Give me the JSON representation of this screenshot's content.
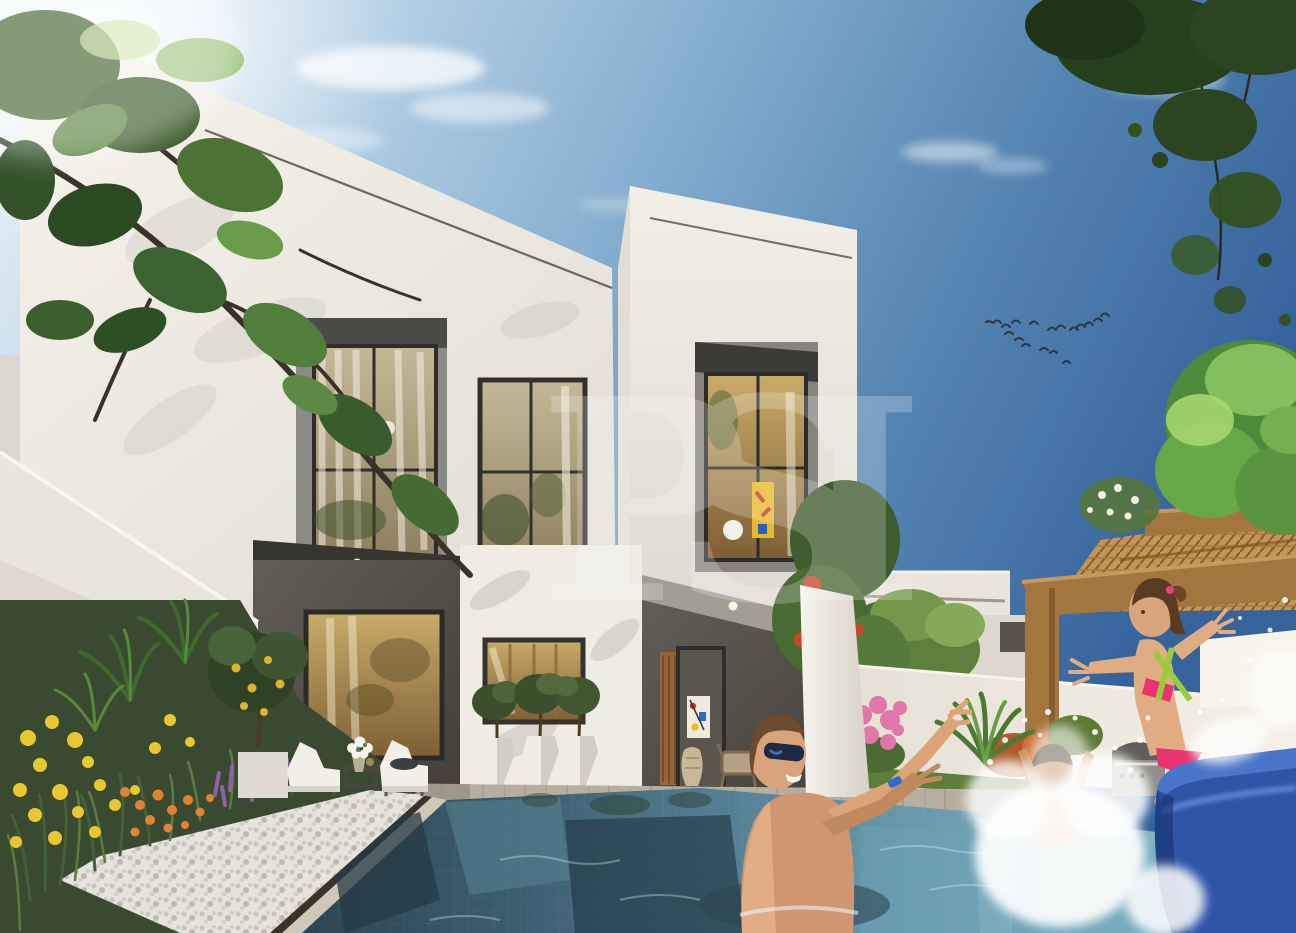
{
  "page": {
    "title": "Modern villa backyard pool — architectural rendering"
  },
  "watermark": {
    "text": "PSI"
  },
  "scene": {
    "setting": "Sunny backyard of a modern two-storey white villa with a private mosaic-tile pool",
    "sky": {
      "condition": "clear blue with wispy clouds",
      "birds_flying": 17
    },
    "people": [
      {
        "label": "man wearing blue sunglasses standing in the pool, arms outstretched"
      },
      {
        "label": "boy splashing in the pool amid white spray"
      },
      {
        "label": "girl in a pink two-piece swimsuit jumping from the blue slide"
      }
    ],
    "objects": [
      "two-storey white villa with parapet roof",
      "grey-framed upper-floor windows with curtains",
      "covered patio with glass door and colourful abstract painting",
      "white faceted planters with olive trees",
      "two white sun loungers, side table and white flower bouquet",
      "lemon tree with yellow fruit",
      "flower bed with yellow craspedia, orange blooms and purple lavender",
      "white pebble mulch border",
      "swimming pool with window reflections",
      "timber pergola with woven rattan roof",
      "stainless barbecue grill",
      "blue plastic pool slide",
      "lawn with stone stepping pads",
      "white perimeter walls and neighbouring villas",
      "overhanging tree canopies",
      "flock of birds in the sky"
    ],
    "colors": {
      "sky_light": "#d4e6f2",
      "sky_deep": "#3b699f",
      "villa_wall": "#efece4",
      "dark_panel": "#57544d",
      "pool_dark": "#2b4350",
      "pool_light": "#8fc0cd",
      "slide_blue": "#2e55a8",
      "bikini_pink": "#e8336e",
      "pergola_wood": "#a4763f",
      "lawn_green": "#5d7d3b",
      "flower_yellow": "#e8c832",
      "flower_orange": "#e08334",
      "flower_purple": "#8a63a0",
      "flower_pink": "#e077a8",
      "foliage_green": "#4e7a38",
      "watermark_white": "#ffffff"
    }
  }
}
